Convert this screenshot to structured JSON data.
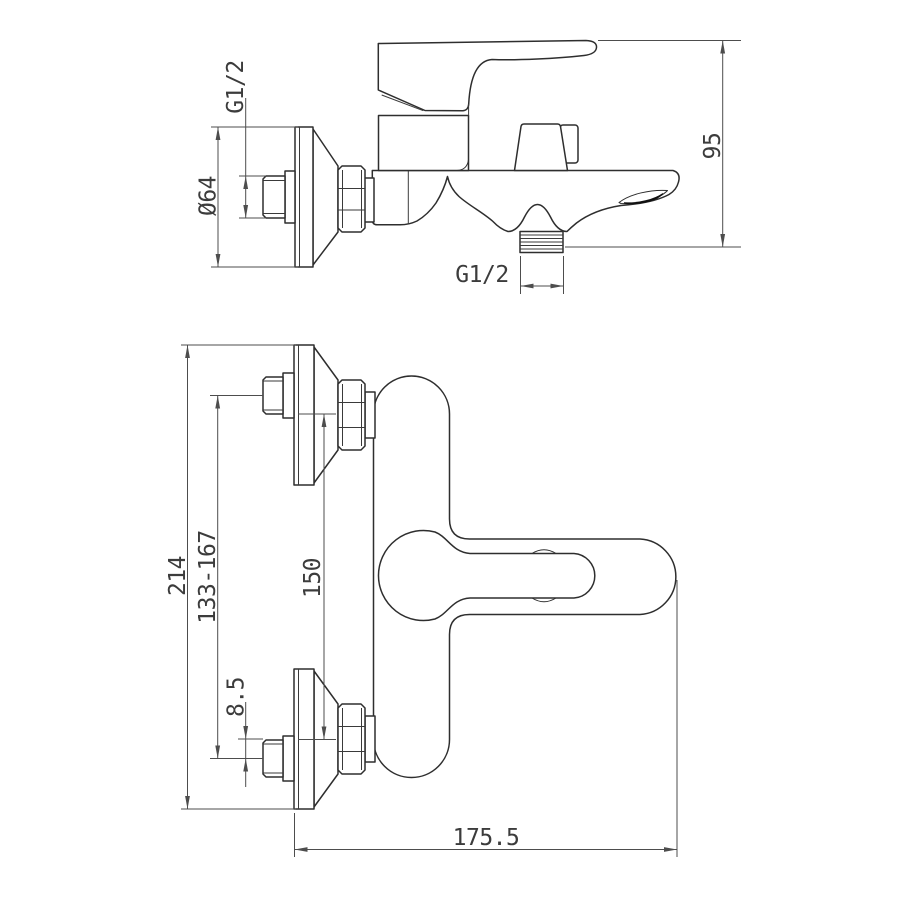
{
  "drawing": {
    "product": "wall-mounted bath mixer tap, two-view installation drawing",
    "style": {
      "background": "#ffffff",
      "outline_color": "#2e2e2e",
      "dimension_color": "#4d4d4d",
      "text_color": "#3c3c3c"
    }
  },
  "dimensions": {
    "side_view": {
      "inlet_thread": "G1/2",
      "escutcheon_diameter": "Ø64",
      "height": "95",
      "outlet_thread": "G1/2"
    },
    "front_view": {
      "overall_span": "214",
      "adjustment_range": "133-167",
      "pipe_centers": "150",
      "eccentric_offset": "8.5",
      "projection_length": "175.5"
    }
  }
}
